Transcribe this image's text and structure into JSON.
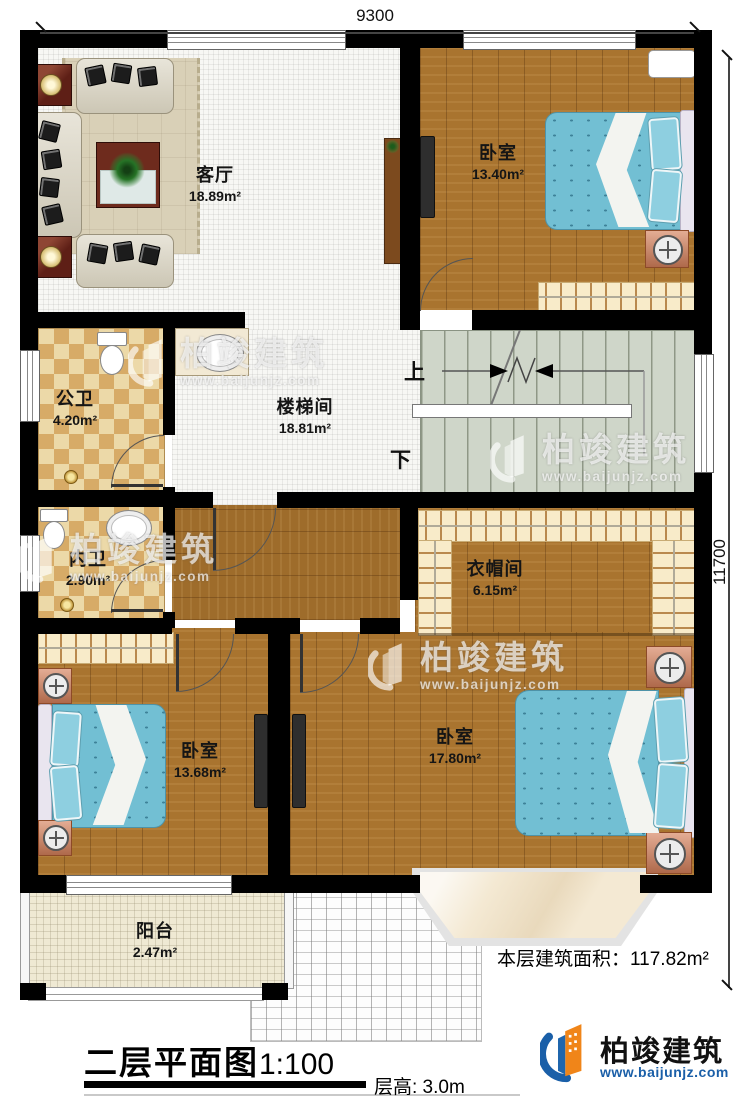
{
  "dimensions": {
    "top": "9300",
    "right": "11700"
  },
  "rooms": [
    {
      "id": "living",
      "name": "客厅",
      "area": "18.89m²"
    },
    {
      "id": "bedroom-top",
      "name": "卧室",
      "area": "13.40m²"
    },
    {
      "id": "public-bath",
      "name": "公卫",
      "area": "4.20m²"
    },
    {
      "id": "stairwell",
      "name": "楼梯间",
      "area": "18.81m²"
    },
    {
      "id": "ensuite-bath",
      "name": "内卫",
      "area": "2.90m²"
    },
    {
      "id": "cloakroom",
      "name": "衣帽间",
      "area": "6.15m²"
    },
    {
      "id": "bedroom-left",
      "name": "卧室",
      "area": "13.68m²"
    },
    {
      "id": "bedroom-right",
      "name": "卧室",
      "area": "17.80m²"
    },
    {
      "id": "balcony",
      "name": "阳台",
      "area": "2.47m²"
    }
  ],
  "stairs": {
    "up": "上",
    "down": "下"
  },
  "watermark": {
    "brand": "柏竣建筑",
    "url": "www.baijunjz.com"
  },
  "footer": {
    "floor_area_label": "本层建筑面积：",
    "floor_area_value": "117.82m²",
    "plan_title": "二层平面图",
    "plan_scale": "1:100",
    "floor_height": "层高: 3.0m",
    "logo_brand": "柏竣建筑",
    "logo_url": "www.baijunjz.com"
  },
  "colors": {
    "wall": "#000000",
    "wood": "#a9742f",
    "tile": "#f7f7f4",
    "bed_blue": "#72bfd3",
    "checker_tan": "#d7ab67",
    "stair": "#cfd6c9",
    "brand_blue": "#1a5fa8",
    "brand_orange": "#f08519"
  }
}
